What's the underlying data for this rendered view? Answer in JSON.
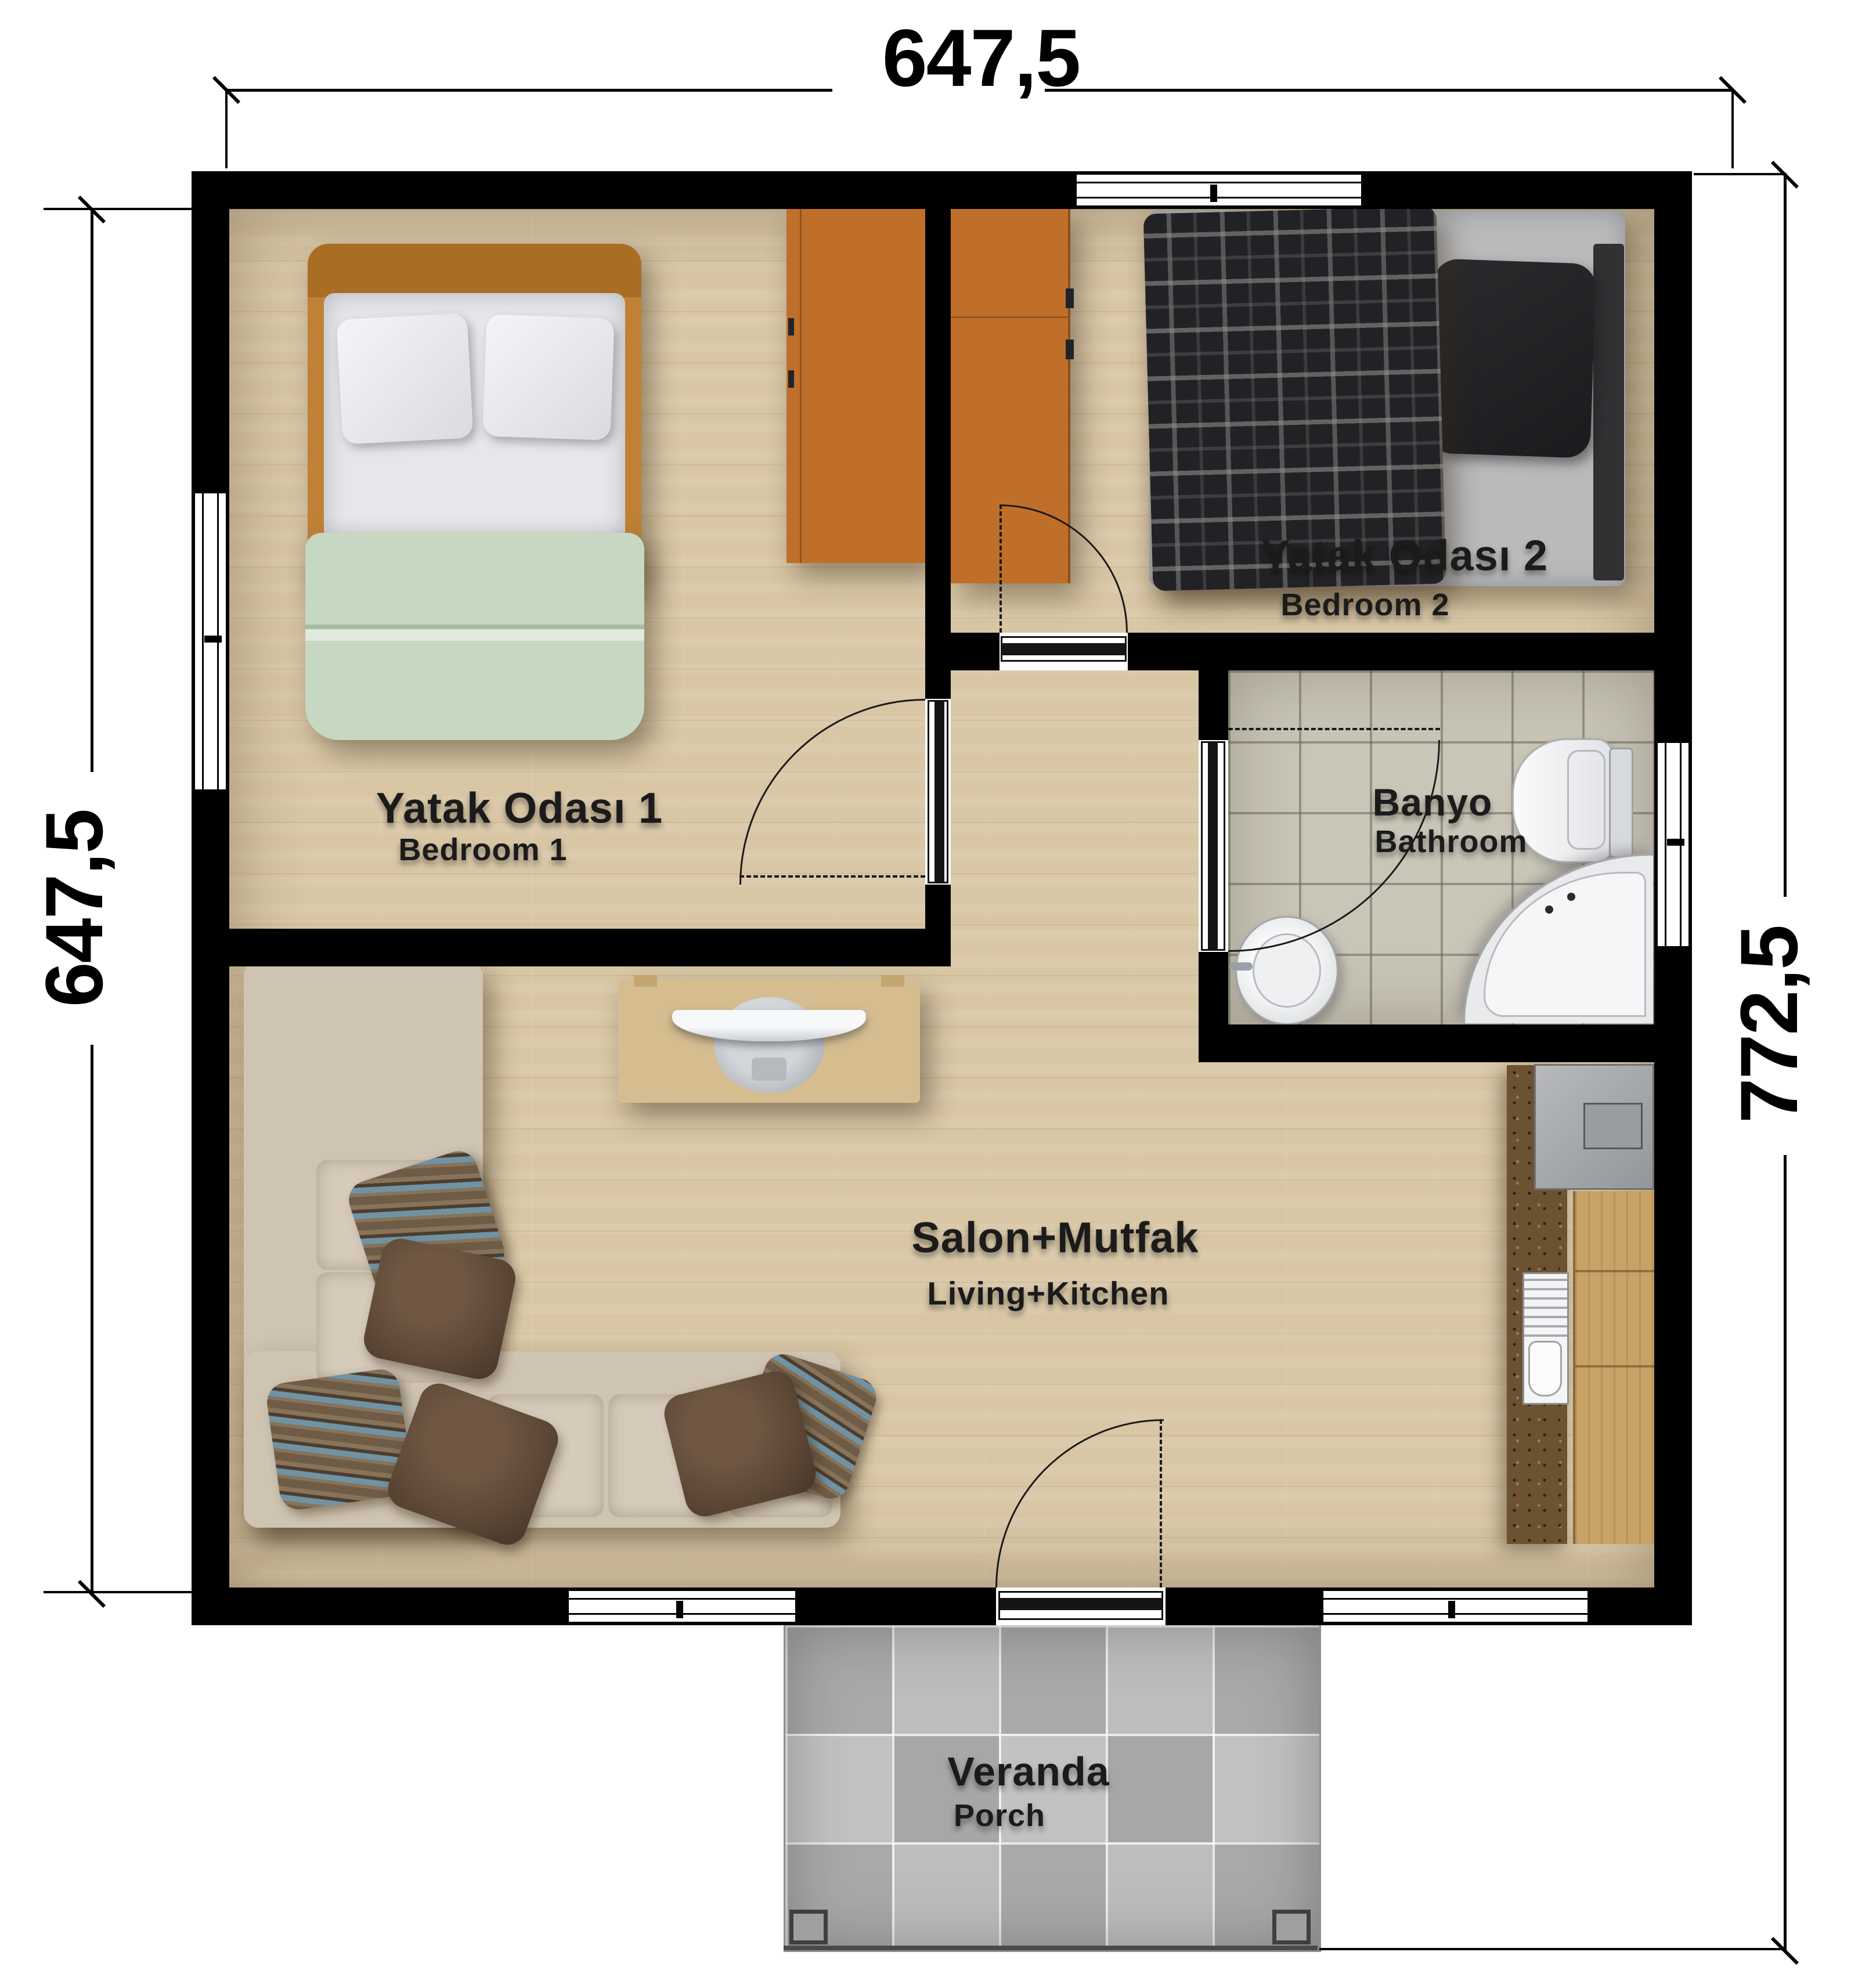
{
  "dimensions": {
    "top": "647,5",
    "left": "647,5",
    "right": "772,5"
  },
  "rooms": {
    "bedroom1": {
      "label_tr": "Yatak Odası 1",
      "label_en": "Bedroom 1"
    },
    "bedroom2": {
      "label_tr": "Yatak Odası 2",
      "label_en": "Bedroom 2"
    },
    "bathroom": {
      "label_tr": "Banyo",
      "label_en": "Bathroom"
    },
    "living": {
      "label_tr": "Salon+Mutfak",
      "label_en": "Living+Kitchen"
    },
    "veranda": {
      "label_tr": "Veranda",
      "label_en": "Porch"
    }
  },
  "colors": {
    "wall": "#000000",
    "wood_floor": "#d8c6a5",
    "bath_tile": "#c9c5b7",
    "porch_tile": "#b3b3b3",
    "wardrobe_orange": "#bf6f2a",
    "duvet_green": "#c6d7c2",
    "sofa_beige": "#cfc3b1",
    "counter_brown": "#6d5231",
    "cabinet_oak": "#c9a268",
    "console_tan": "#d6bd90"
  }
}
